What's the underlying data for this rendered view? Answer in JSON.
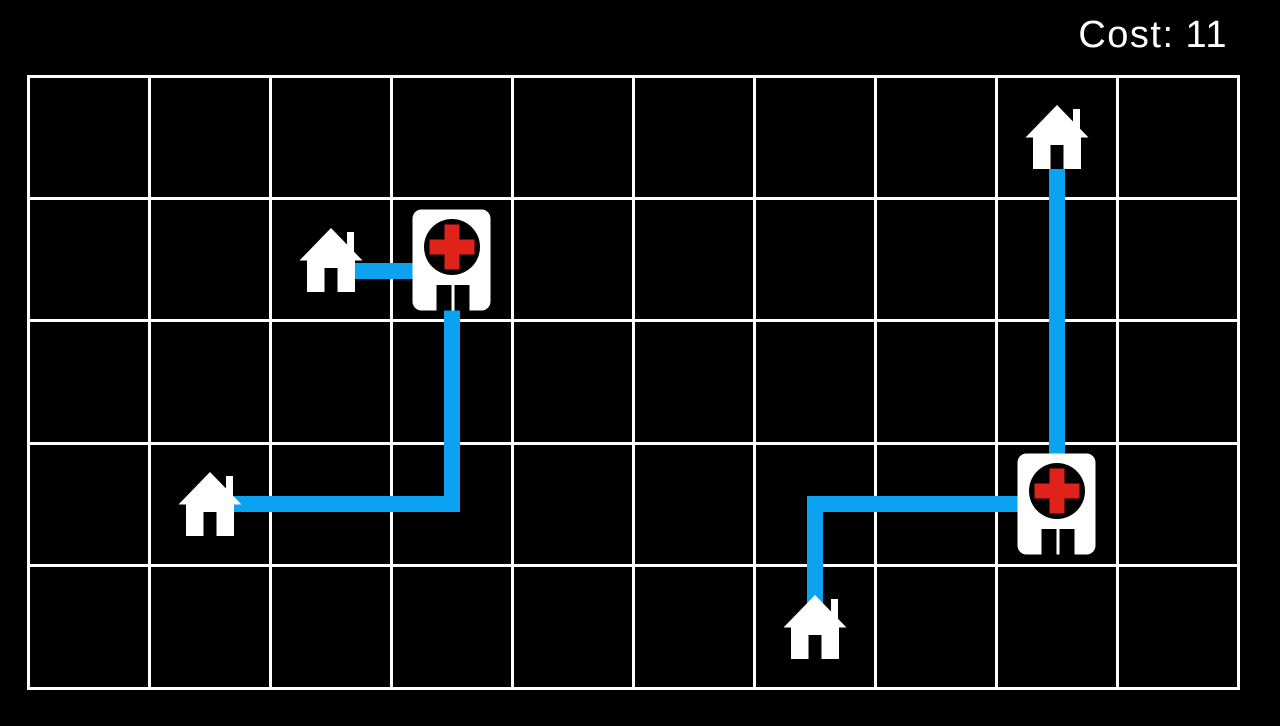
{
  "hud": {
    "cost_label": "Cost:",
    "cost_value": "11"
  },
  "colors": {
    "background": "#000000",
    "grid_line": "#ffffff",
    "path": "#0ba2f2",
    "building": "#ffffff",
    "hospital_cross": "#e0231a",
    "text": "#ffffff"
  },
  "grid": {
    "cols": 10,
    "rows": 5,
    "left": 28,
    "top": 76,
    "width": 1210,
    "height": 612,
    "line_width": 3
  },
  "path_width": 16,
  "entities": {
    "houses": [
      {
        "id": "house-1",
        "col": 2,
        "row": 1
      },
      {
        "id": "house-2",
        "col": 1,
        "row": 3
      },
      {
        "id": "house-3",
        "col": 6,
        "row": 4
      },
      {
        "id": "house-4",
        "col": 8,
        "row": 0
      }
    ],
    "hospitals": [
      {
        "id": "hospital-1",
        "col": 3,
        "row": 1
      },
      {
        "id": "hospital-2",
        "col": 8,
        "row": 3
      }
    ]
  },
  "paths": [
    {
      "id": "path-1",
      "from": "house-1",
      "to": "hospital-1",
      "points": [
        [
          2,
          1
        ],
        [
          3,
          1
        ]
      ],
      "y_offset": 11
    },
    {
      "id": "path-2",
      "from": "hospital-1",
      "to": "house-2",
      "points": [
        [
          3,
          1
        ],
        [
          3,
          3
        ],
        [
          1,
          3
        ]
      ]
    },
    {
      "id": "path-3",
      "from": "house-3",
      "to": "hospital-2",
      "points": [
        [
          6,
          4
        ],
        [
          6,
          3
        ],
        [
          8,
          3
        ]
      ]
    },
    {
      "id": "path-4",
      "from": "house-4",
      "to": "hospital-2",
      "points": [
        [
          8,
          0
        ],
        [
          8,
          3
        ]
      ]
    }
  ]
}
